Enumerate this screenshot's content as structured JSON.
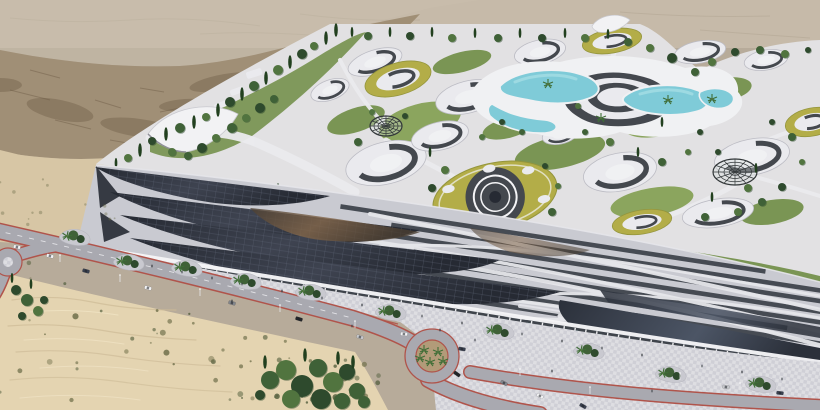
{
  "scene": {
    "subject": "aerial-architectural-render-desert-eco-resort",
    "features": [
      "desert-plateau",
      "cliff-escarpment",
      "sand-dunes",
      "resort-campus",
      "ring-buildings-with-green-roofs",
      "central-pool-complex",
      "geodesic-domes",
      "tensile-canopy",
      "solar-roof-megastructure",
      "retail-arcade",
      "paved-plaza",
      "roads-with-roundabouts",
      "vehicles",
      "pedestrians",
      "trees"
    ]
  },
  "colors": {
    "plateau": "#b7ab9a",
    "plateau_light": "#c9bead",
    "cliff": "#a08f76",
    "cliff_dark": "#6e5c46",
    "beach": "#d7c6a5",
    "sand": "#e4d4b1",
    "sand_ripple": "#cdba96",
    "sand_light": "#f0e3c4",
    "scrub": "#6f6f4a",
    "scrub_dark": "#55603f",
    "campus": "#e2e1e3",
    "lawn": "#7a9554",
    "lawn_light": "#8ba55e",
    "lawn_dark": "#61803f",
    "tree": "#2e4a2d",
    "tree_mid": "#3f6137",
    "tree_light": "#51743f",
    "cypress": "#22401f",
    "palm": "#3e6d36",
    "meadow": "#b3ad48",
    "meadow_dark": "#94953c",
    "white_bld": "#eaeaee",
    "bld_shadow": "#bcbcc4",
    "window_band": "#44484e",
    "pool": "#7fcbd8",
    "pool_light": "#aadfe7",
    "deck": "#f0f1f3",
    "dome": "#33383a",
    "solar": "#3e4350",
    "solar_dark": "#262a33",
    "solar_line": "#5b6172",
    "bronze": "#85684b",
    "bronze_dark": "#4a3e31",
    "woven_base": "#c9cad1",
    "woven_dark": "#3b4048",
    "ribbon": "#e6e6ea",
    "glass": "#2b303a",
    "glass_sheen": "#4c5565",
    "arcade_dark": "#3f444b",
    "arcade_teal": "#6fa098",
    "column": "#f4f4f6",
    "path_white": "#ebebee",
    "plaza": "#dedee2",
    "plaza_alt": "#cfcfd6",
    "red_trim": "#b0544b",
    "road": "#a9a9b0",
    "marking": "#ececf0",
    "island_soil": "#b29b79",
    "planter": "#c9c9d0",
    "people": "#3a3e44",
    "shadow": "#8f8f97",
    "car_white": "#f2f2f4",
    "car_black": "#24262a",
    "car_gray": "#83868c",
    "car_silver": "#c6c8cc",
    "car_dark": "#3a4150"
  },
  "objects": {
    "ring_buildings": [
      [
        375,
        62,
        28,
        12,
        -18,
        "w"
      ],
      [
        330,
        90,
        20,
        10,
        -20,
        "w"
      ],
      [
        398,
        79,
        34,
        16,
        -16,
        "m"
      ],
      [
        468,
        97,
        33,
        16,
        -14,
        "w"
      ],
      [
        540,
        52,
        26,
        12,
        -12,
        "w"
      ],
      [
        612,
        41,
        30,
        12,
        -10,
        "m"
      ],
      [
        700,
        52,
        26,
        11,
        -10,
        "w"
      ],
      [
        766,
        60,
        22,
        10,
        -10,
        "w"
      ],
      [
        386,
        163,
        41,
        21,
        -14,
        "w"
      ],
      [
        440,
        136,
        29,
        14,
        -13,
        "w"
      ],
      [
        495,
        196,
        63,
        33,
        -12,
        "p"
      ],
      [
        620,
        172,
        37,
        19,
        -11,
        "w"
      ],
      [
        752,
        157,
        38,
        18,
        -11,
        "w"
      ],
      [
        812,
        122,
        27,
        14,
        -11,
        "m"
      ],
      [
        690,
        106,
        21,
        10,
        -11,
        "w"
      ],
      [
        718,
        213,
        36,
        14,
        -9,
        "w"
      ],
      [
        642,
        222,
        30,
        12,
        -9,
        "m"
      ],
      [
        560,
        135,
        18,
        9,
        -12,
        "w"
      ]
    ],
    "domes": [
      [
        386,
        126,
        16,
        10
      ],
      [
        735,
        172,
        22,
        13
      ]
    ],
    "trees_bg": [
      [
        336,
        30,
        4,
        "c"
      ],
      [
        326,
        38,
        4,
        "c"
      ],
      [
        314,
        46,
        4,
        "t"
      ],
      [
        302,
        54,
        5,
        "t"
      ],
      [
        290,
        62,
        4,
        "c"
      ],
      [
        278,
        70,
        5,
        "t"
      ],
      [
        266,
        78,
        4,
        "c"
      ],
      [
        254,
        86,
        5,
        "t"
      ],
      [
        242,
        94,
        4,
        "c"
      ],
      [
        230,
        102,
        5,
        "t"
      ],
      [
        218,
        110,
        4,
        "c"
      ],
      [
        206,
        117,
        4,
        "t"
      ],
      [
        194,
        122,
        4,
        "c"
      ],
      [
        180,
        128,
        5,
        "t"
      ],
      [
        166,
        134,
        4,
        "c"
      ],
      [
        152,
        141,
        4,
        "t"
      ],
      [
        140,
        150,
        4,
        "c"
      ],
      [
        128,
        158,
        4,
        "t"
      ],
      [
        116,
        163,
        3,
        "c"
      ],
      [
        232,
        128,
        5,
        "t"
      ],
      [
        246,
        118,
        4,
        "t"
      ],
      [
        260,
        108,
        5,
        "t"
      ],
      [
        274,
        99,
        4,
        "t"
      ],
      [
        216,
        138,
        4,
        "t"
      ],
      [
        202,
        148,
        5,
        "t"
      ],
      [
        188,
        156,
        4,
        "t"
      ],
      [
        172,
        152,
        4,
        "t"
      ],
      [
        352,
        32,
        3,
        "c"
      ],
      [
        368,
        36,
        4,
        "t"
      ],
      [
        390,
        32,
        3,
        "c"
      ],
      [
        410,
        36,
        4,
        "t"
      ],
      [
        432,
        32,
        3,
        "c"
      ],
      [
        452,
        38,
        4,
        "t"
      ],
      [
        475,
        33,
        3,
        "c"
      ],
      [
        498,
        38,
        4,
        "t"
      ],
      [
        520,
        33,
        3,
        "c"
      ],
      [
        542,
        38,
        4,
        "t"
      ],
      [
        565,
        33,
        3,
        "c"
      ],
      [
        585,
        38,
        4,
        "t"
      ],
      [
        608,
        34,
        3,
        "c"
      ],
      [
        628,
        42,
        4,
        "t"
      ],
      [
        650,
        48,
        4,
        "t"
      ],
      [
        672,
        58,
        5,
        "t"
      ],
      [
        695,
        72,
        4,
        "t"
      ],
      [
        712,
        62,
        4,
        "t"
      ],
      [
        735,
        52,
        4,
        "t"
      ],
      [
        760,
        50,
        4,
        "t"
      ],
      [
        785,
        54,
        4,
        "t"
      ],
      [
        808,
        50,
        3,
        "t"
      ],
      [
        255,
        186,
        4,
        "t"
      ],
      [
        278,
        190,
        4,
        "c"
      ],
      [
        300,
        195,
        5,
        "t"
      ],
      [
        322,
        199,
        4,
        "c"
      ],
      [
        345,
        204,
        5,
        "t"
      ],
      [
        368,
        208,
        4,
        "c"
      ],
      [
        392,
        212,
        5,
        "t"
      ],
      [
        415,
        217,
        4,
        "c"
      ],
      [
        438,
        222,
        5,
        "t"
      ],
      [
        462,
        227,
        4,
        "c"
      ],
      [
        485,
        232,
        5,
        "t"
      ],
      [
        508,
        237,
        4,
        "c"
      ],
      [
        532,
        242,
        5,
        "t"
      ],
      [
        556,
        247,
        4,
        "c"
      ],
      [
        580,
        252,
        5,
        "t"
      ],
      [
        604,
        257,
        4,
        "c"
      ],
      [
        628,
        262,
        5,
        "t"
      ],
      [
        652,
        268,
        4,
        "c"
      ],
      [
        676,
        273,
        5,
        "t"
      ],
      [
        700,
        279,
        4,
        "c"
      ],
      [
        724,
        284,
        5,
        "t"
      ],
      [
        748,
        290,
        4,
        "c"
      ],
      [
        772,
        295,
        5,
        "t"
      ],
      [
        796,
        301,
        4,
        "t"
      ],
      [
        430,
        152,
        3,
        "c"
      ],
      [
        372,
        112,
        3,
        "t"
      ],
      [
        405,
        116,
        3,
        "t"
      ],
      [
        358,
        142,
        4,
        "t"
      ],
      [
        445,
        170,
        4,
        "t"
      ],
      [
        432,
        188,
        4,
        "t"
      ],
      [
        452,
        214,
        4,
        "t"
      ],
      [
        475,
        225,
        4,
        "t"
      ],
      [
        528,
        228,
        4,
        "t"
      ],
      [
        552,
        212,
        4,
        "t"
      ],
      [
        558,
        186,
        3,
        "t"
      ],
      [
        545,
        166,
        3,
        "t"
      ],
      [
        585,
        132,
        3,
        "t"
      ],
      [
        610,
        142,
        4,
        "t"
      ],
      [
        638,
        152,
        3,
        "c"
      ],
      [
        662,
        162,
        4,
        "t"
      ],
      [
        688,
        152,
        3,
        "t"
      ],
      [
        700,
        132,
        3,
        "t"
      ],
      [
        662,
        122,
        3,
        "c"
      ],
      [
        578,
        106,
        3,
        "t"
      ],
      [
        502,
        122,
        3,
        "t"
      ],
      [
        522,
        132,
        3,
        "t"
      ],
      [
        482,
        137,
        3,
        "t"
      ],
      [
        718,
        152,
        3,
        "t"
      ],
      [
        756,
        168,
        3,
        "c"
      ],
      [
        748,
        188,
        4,
        "t"
      ],
      [
        772,
        122,
        3,
        "t"
      ],
      [
        792,
        137,
        4,
        "t"
      ],
      [
        802,
        162,
        3,
        "t"
      ],
      [
        782,
        187,
        4,
        "t"
      ],
      [
        762,
        202,
        4,
        "t"
      ],
      [
        738,
        212,
        4,
        "t"
      ],
      [
        712,
        197,
        3,
        "c"
      ],
      [
        705,
        217,
        4,
        "t"
      ],
      [
        548,
        84,
        3,
        "p"
      ],
      [
        601,
        118,
        3,
        "p"
      ],
      [
        668,
        100,
        3,
        "p"
      ],
      [
        712,
        99,
        3,
        "p"
      ]
    ],
    "trees_fg": [
      [
        16,
        290,
        5,
        "t"
      ],
      [
        27,
        300,
        6,
        "t"
      ],
      [
        38,
        311,
        5,
        "t"
      ],
      [
        22,
        316,
        4,
        "t"
      ],
      [
        31,
        284,
        3,
        "c"
      ],
      [
        12,
        278,
        3,
        "c"
      ],
      [
        44,
        300,
        4,
        "t"
      ],
      [
        270,
        380,
        9,
        "t"
      ],
      [
        286,
        370,
        10,
        "t"
      ],
      [
        302,
        386,
        11,
        "t"
      ],
      [
        318,
        368,
        9,
        "t"
      ],
      [
        333,
        382,
        10,
        "t"
      ],
      [
        347,
        372,
        8,
        "t"
      ],
      [
        357,
        391,
        8,
        "t"
      ],
      [
        291,
        399,
        9,
        "t"
      ],
      [
        321,
        399,
        10,
        "t"
      ],
      [
        342,
        401,
        8,
        "t"
      ],
      [
        265,
        362,
        4,
        "c"
      ],
      [
        305,
        355,
        4,
        "c"
      ],
      [
        338,
        358,
        4,
        "c"
      ],
      [
        353,
        362,
        4,
        "c"
      ],
      [
        260,
        395,
        5,
        "t"
      ],
      [
        364,
        402,
        6,
        "t"
      ],
      [
        424,
        350,
        4,
        "p"
      ],
      [
        438,
        352,
        5,
        "p"
      ],
      [
        430,
        362,
        4,
        "p"
      ],
      [
        443,
        361,
        4,
        "p"
      ],
      [
        420,
        358,
        4,
        "p"
      ]
    ],
    "planters": [
      [
        76,
        237
      ],
      [
        130,
        262
      ],
      [
        188,
        268
      ],
      [
        247,
        281
      ],
      [
        312,
        292
      ],
      [
        392,
        312
      ],
      [
        500,
        331
      ],
      [
        590,
        351
      ],
      [
        672,
        374
      ],
      [
        762,
        384
      ]
    ],
    "cars": [
      [
        50,
        256,
        14,
        "car_white"
      ],
      [
        86,
        271,
        15,
        "car_dark"
      ],
      [
        148,
        288,
        15,
        "car_white"
      ],
      [
        232,
        303,
        16,
        "car_gray"
      ],
      [
        299,
        319,
        17,
        "car_black"
      ],
      [
        360,
        337,
        18,
        "car_silver"
      ],
      [
        404,
        334,
        5,
        "car_white"
      ],
      [
        462,
        349,
        10,
        "car_dark"
      ],
      [
        457,
        374,
        35,
        "car_black"
      ],
      [
        504,
        383,
        28,
        "car_gray"
      ],
      [
        540,
        396,
        30,
        "car_white"
      ],
      [
        583,
        406,
        30,
        "car_dark"
      ],
      [
        17,
        247,
        10,
        "car_white"
      ],
      [
        780,
        393,
        8,
        "car_dark"
      ],
      [
        726,
        387,
        8,
        "car_silver"
      ]
    ],
    "people": [
      [
        152,
        266
      ],
      [
        182,
        272
      ],
      [
        212,
        278
      ],
      [
        242,
        284
      ],
      [
        282,
        291
      ],
      [
        322,
        298
      ],
      [
        362,
        305
      ],
      [
        422,
        316
      ],
      [
        462,
        323
      ],
      [
        522,
        334
      ],
      [
        562,
        341
      ],
      [
        602,
        348
      ],
      [
        642,
        355
      ],
      [
        702,
        366
      ],
      [
        742,
        372
      ],
      [
        782,
        379
      ],
      [
        232,
        301
      ],
      [
        352,
        326
      ],
      [
        552,
        371
      ],
      [
        652,
        391
      ],
      [
        440,
        330
      ],
      [
        475,
        340
      ]
    ],
    "street_lights": [
      [
        120,
        282
      ],
      [
        200,
        296
      ],
      [
        280,
        312
      ],
      [
        355,
        328
      ],
      [
        470,
        360
      ],
      [
        520,
        376
      ],
      [
        590,
        394
      ],
      [
        60,
        262
      ],
      [
        680,
        380
      ],
      [
        740,
        390
      ]
    ]
  }
}
